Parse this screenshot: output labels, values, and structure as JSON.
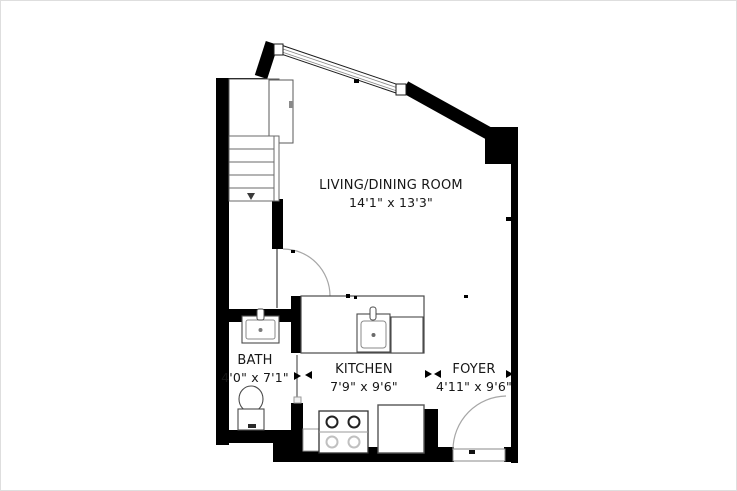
{
  "page": {
    "background_color": "#ffffff",
    "border_color": "#dedede"
  },
  "floor_plan": {
    "kind": "studio-apartment-floor-plan",
    "wall_color": "#000000",
    "label_color": "#161616",
    "rooms": [
      {
        "name": "LIVING/DINING ROOM",
        "dimensions": "14'1\" x 13'3\""
      },
      {
        "name": "BATH",
        "dimensions": "4'0\" x 7'1\""
      },
      {
        "name": "KITCHEN",
        "dimensions": "7'9\" x 9'6\""
      },
      {
        "name": "FOYER",
        "dimensions": "4'11\" x 9'6\""
      }
    ],
    "fixtures": [
      "staircase",
      "closet",
      "window",
      "interior-door",
      "bath-door",
      "kitchen-counter",
      "kitchen-sink",
      "dishwasher",
      "range",
      "refrigerator",
      "vanity-sink",
      "toilet",
      "entry-door"
    ]
  }
}
